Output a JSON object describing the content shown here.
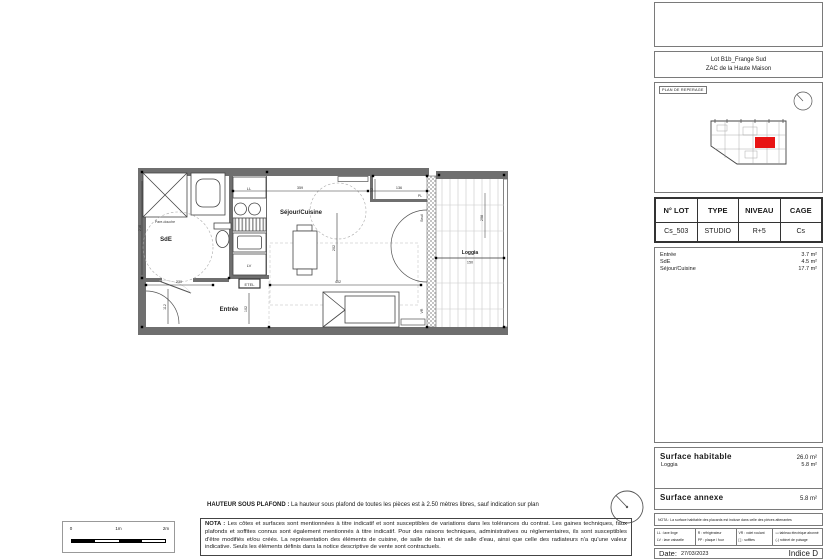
{
  "sheet": {
    "hauteur_label": "HAUTEUR SOUS PLAFOND :",
    "hauteur_text": "La hauteur sous plafond de toutes les pièces est à 2.50 mètres libres, sauf indication sur plan",
    "nota_label": "NOTA :",
    "nota_text": "Les côtes et surfaces sont mentionnées à titre indicatif et sont susceptibles de variations dans les tolérances du contrat. Les gaines techniques, faux plafonds et soffites connus sont également mentionnés à titre indicatif. Pour des raisons techniques, administratives ou réglementaires, ils sont susceptibles d'être modifiés et/ou créés. La représentation des éléments de cuisine, de salle de bain et de salle d'eau, ainsi que celle des radiateurs n'a qu'une valeur indicative. Seuls les éléments définis dans la notice descriptive de vente sont contractuels.",
    "scale": {
      "t0": "0",
      "t1": "1m",
      "t2": "2m"
    }
  },
  "plan": {
    "rooms": {
      "sde": "SdE",
      "entree": "Entrée",
      "sejour": "Séjour/Cuisine",
      "loggia": "Loggia",
      "pare_douche": "Pare-douche"
    },
    "labels": {
      "ll": "LL",
      "lv": "LV",
      "etel": "ETEL",
      "vr": "VR",
      "seuil": "Seuil",
      "pl": "PL"
    },
    "dims": {
      "top_main": "359",
      "top_right": "136",
      "notch": "52",
      "entree_w": "230",
      "entree_h": "112",
      "entree_h2": "102",
      "sejour_w": "402",
      "sejour_h": "202",
      "sde_h": "216",
      "loggia_w": "150",
      "loggia_h": "298"
    }
  },
  "panel": {
    "project": {
      "line1": "Lot B1b_Frange Sud",
      "line2": "ZAC de la Haute Maison"
    },
    "reperage_label": "PLAN DE REPERAGE",
    "lot_table": {
      "headers": [
        "N° LOT",
        "TYPE",
        "NIVEAU",
        "CAGE"
      ],
      "row": [
        "Cs_503",
        "STUDIO",
        "R+5",
        "Cs"
      ]
    },
    "areas": [
      {
        "name": "Entrée",
        "value": "3.7 m²"
      },
      {
        "name": "SdE",
        "value": "4.5 m²"
      },
      {
        "name": "Séjour/Cuisine",
        "value": "17.7 m²"
      }
    ],
    "surface_habitable": {
      "label": "Surface habitable",
      "value": "26.0 m²",
      "loggia_label": "Loggia",
      "loggia_value": "5.8 m²"
    },
    "surface_annexe": {
      "label": "Surface annexe",
      "value": "5.8 m²"
    },
    "nota": "NOTA : La surface habitable des placards est incluse dans celle des pièces attenantes",
    "legend": {
      "r1c1": "LL : lave linge",
      "r1c2": "R : réfrigérateur",
      "r1c3": "VR : volet roulant",
      "r1c4": "▭ tableau électrique abonné",
      "r2c1": "LV : lave vaisselle",
      "r2c2": "PP : plaque / four",
      "r2c3": "[ ] : soffites",
      "r2c4": "(-) robinet de puisage"
    },
    "footer": {
      "date_label": "Date:",
      "date_value": "27/03/2023",
      "indice": "Indice D"
    }
  },
  "colors": {
    "accent_red": "#e81313",
    "wall_gray": "#6f6f6f"
  }
}
